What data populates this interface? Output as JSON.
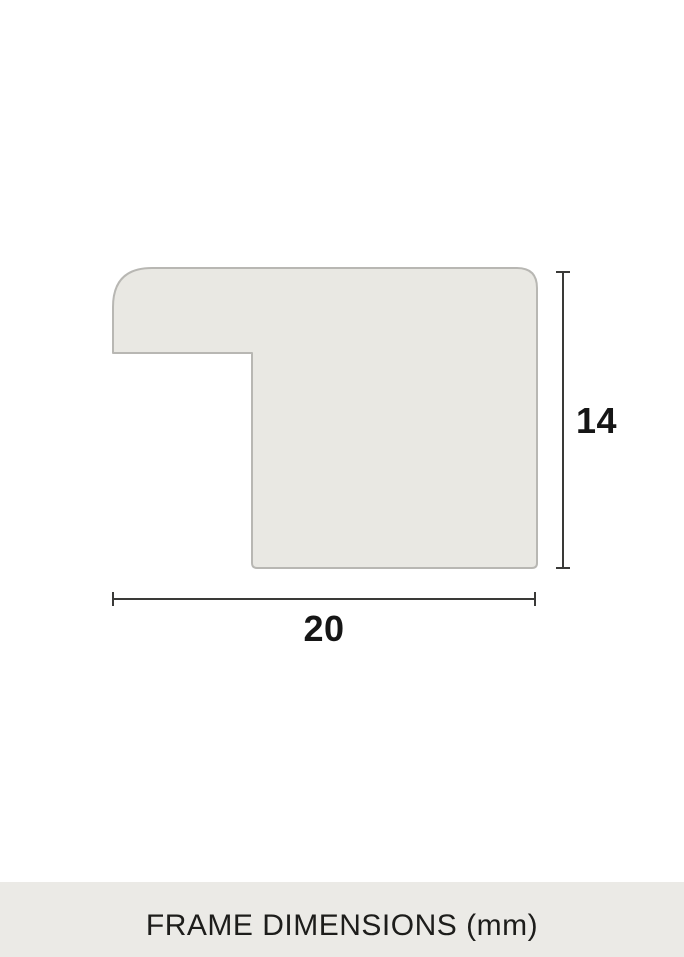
{
  "figure": {
    "type": "frame-profile-cross-section",
    "width_dimension": {
      "value": "20"
    },
    "height_dimension": {
      "value": "14"
    }
  },
  "footer": {
    "caption": "FRAME DIMENSIONS (mm)"
  },
  "colors": {
    "profile_fill": "#e9e8e3",
    "profile_border": "#b8b7b3",
    "footer_bg": "#ebeae6",
    "dimension_line": "#3a3a38",
    "label_text": "#161616",
    "page_bg": "#ffffff"
  }
}
